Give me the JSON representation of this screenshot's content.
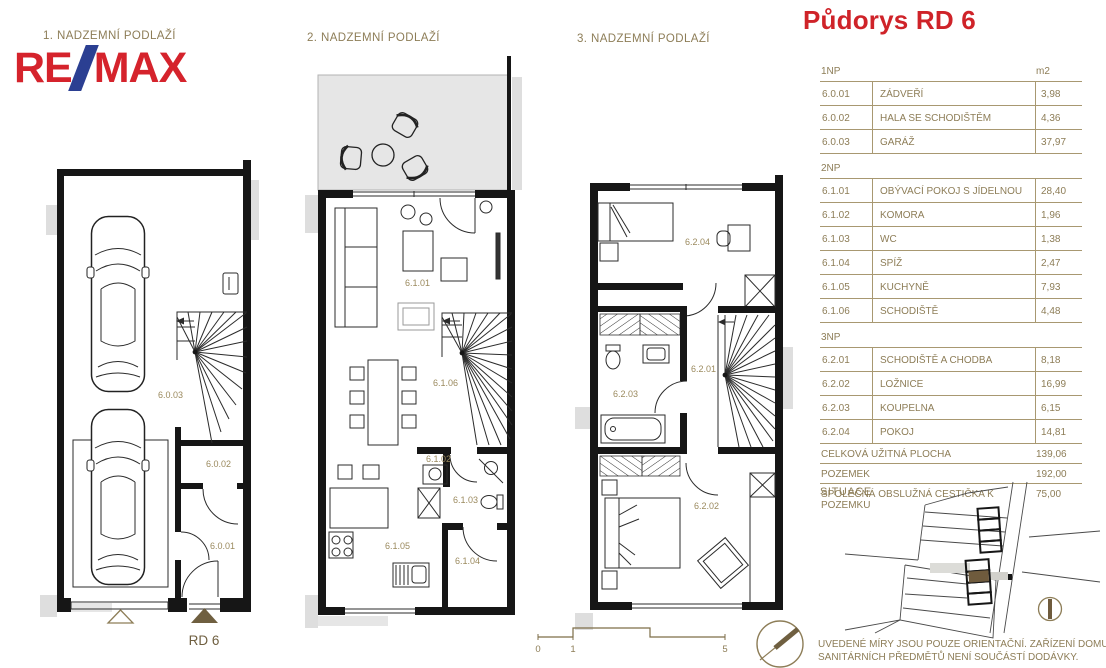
{
  "title": "Půdorys RD 6",
  "logo": {
    "part1": "RE",
    "part2": "MAX"
  },
  "plans": {
    "floor1": {
      "label": "1. NADZEMNÍ PODLAŽÍ",
      "house_label": "RD 6",
      "room_codes": {
        "garage": "6.0.03",
        "hall": "6.0.02",
        "entry": "6.0.01"
      }
    },
    "floor2": {
      "label": "2. NADZEMNÍ PODLAŽÍ",
      "room_codes": {
        "living": "6.1.01",
        "komora": "6.1.02",
        "wc": "6.1.03",
        "spiz": "6.1.04",
        "kitchen": "6.1.05",
        "stairs": "6.1.06"
      }
    },
    "floor3": {
      "label": "3. NADZEMNÍ PODLAŽÍ",
      "room_codes": {
        "stairs_hall": "6.2.01",
        "bedroom": "6.2.02",
        "bathroom": "6.2.03",
        "room": "6.2.04"
      }
    }
  },
  "scale_bar": {
    "t0": "0",
    "t1": "1",
    "t5": "5"
  },
  "area_table": {
    "unit_header": "m2",
    "sections": [
      {
        "header": "1NP",
        "rows": [
          {
            "code": "6.0.01",
            "name": "ZÁDVEŘÍ",
            "area": "3,98"
          },
          {
            "code": "6.0.02",
            "name": "HALA SE SCHODIŠTĚM",
            "area": "4,36"
          },
          {
            "code": "6.0.03",
            "name": "GARÁŽ",
            "area": "37,97"
          }
        ]
      },
      {
        "header": "2NP",
        "rows": [
          {
            "code": "6.1.01",
            "name": "OBÝVACÍ POKOJ S JÍDELNOU",
            "area": "28,40"
          },
          {
            "code": "6.1.02",
            "name": "KOMORA",
            "area": "1,96"
          },
          {
            "code": "6.1.03",
            "name": "WC",
            "area": "1,38"
          },
          {
            "code": "6.1.04",
            "name": "SPÍŽ",
            "area": "2,47"
          },
          {
            "code": "6.1.05",
            "name": "KUCHYNĚ",
            "area": "7,93"
          },
          {
            "code": "6.1.06",
            "name": "SCHODIŠTĚ",
            "area": "4,48"
          }
        ]
      },
      {
        "header": "3NP",
        "rows": [
          {
            "code": "6.2.01",
            "name": "SCHODIŠTĚ A CHODBA",
            "area": "8,18"
          },
          {
            "code": "6.2.02",
            "name": "LOŽNICE",
            "area": "16,99"
          },
          {
            "code": "6.2.03",
            "name": "KOUPELNA",
            "area": "6,15"
          },
          {
            "code": "6.2.04",
            "name": "POKOJ",
            "area": "14,81"
          }
        ]
      }
    ],
    "summary": [
      {
        "name": "CELKOVÁ UŽITNÁ PLOCHA",
        "area": "139,06"
      },
      {
        "name": "POZEMEK",
        "area": "192,00"
      },
      {
        "name": "SPOLEČNÁ OBSLUŽNÁ CESTIČKA K POZEMKU",
        "area": "75,00"
      }
    ]
  },
  "situace": {
    "label": "SITUACE"
  },
  "note": {
    "line1": "UVEDENÉ MÍRY JSOU POUZE ORIENTAČNÍ. ZAŘÍZENÍ DOMU MIMO",
    "line2": "SANITÁRNÍCH PŘEDMĚTŮ NENÍ SOUČÁSTÍ DODÁVKY."
  },
  "colors": {
    "accent_red": "#cf2329",
    "logo_blue": "#2b3f92",
    "drawing_text_olive": "#8d7d57",
    "dark_brown": "#6f5f40",
    "wall_black": "#161616",
    "terrace_gray": "#e6e6e6"
  }
}
